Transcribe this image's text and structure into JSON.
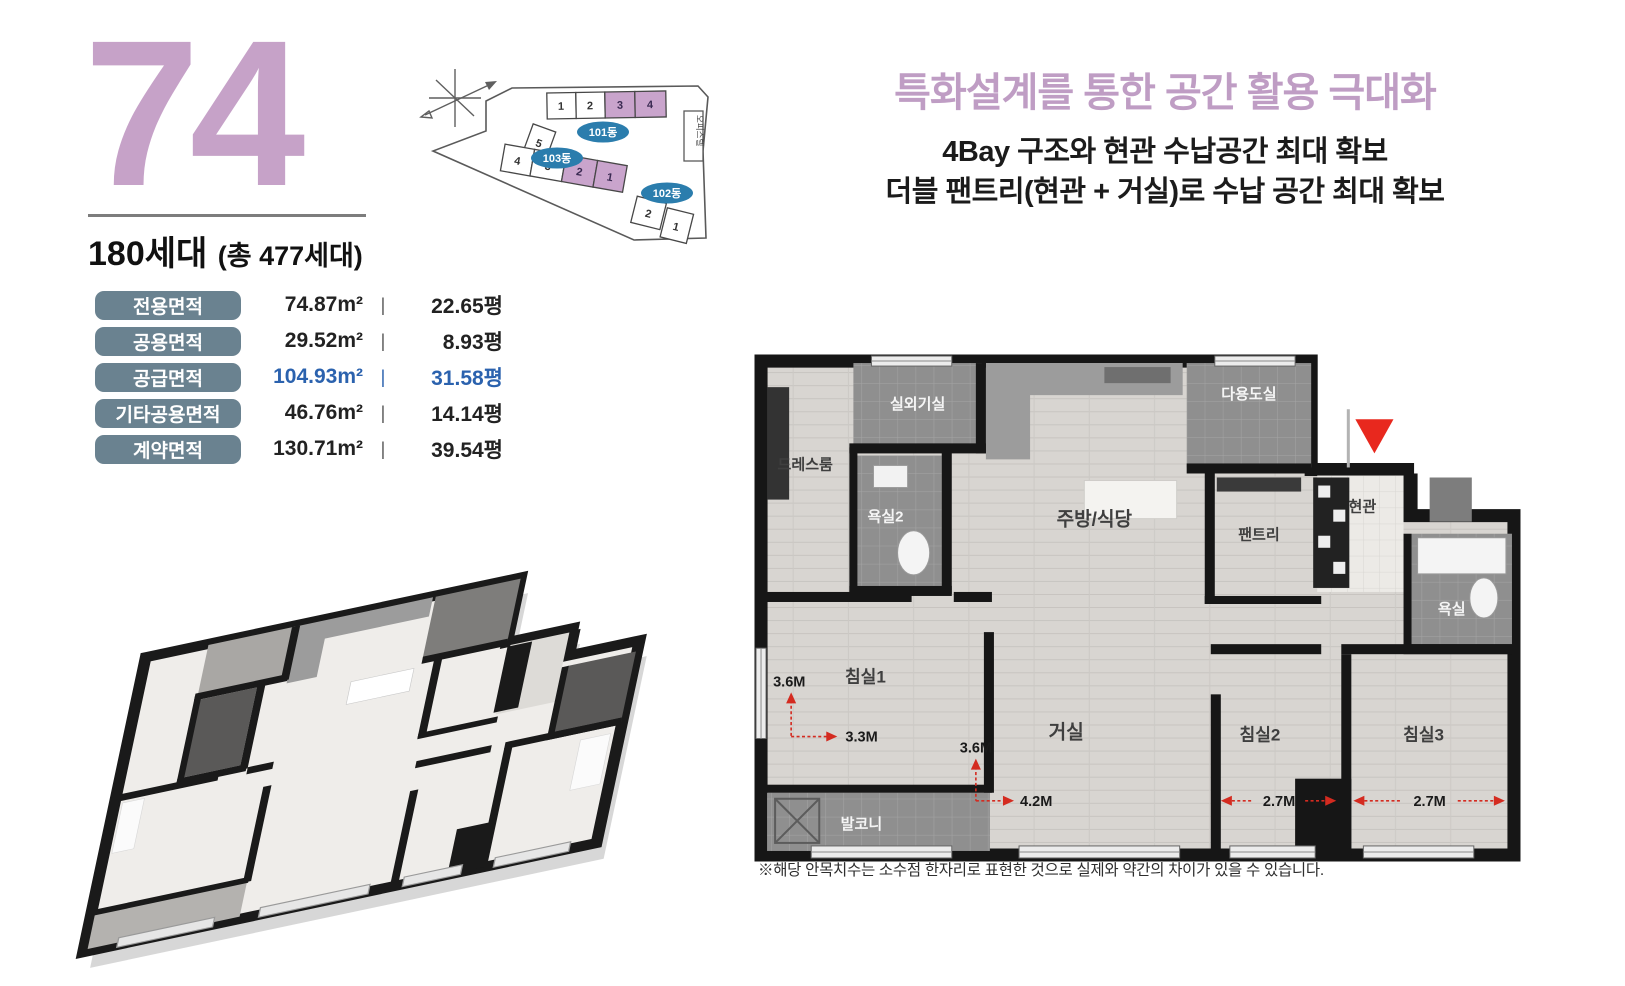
{
  "colors": {
    "accent_purple": "#c6a2c8",
    "headline_purple": "#bf9dc4",
    "pill_slate": "#6a8290",
    "value_blue": "#2b62ae",
    "building_label_blue": "#2b7dad",
    "highlight_unit_purple": "#c9a4cc",
    "dimension_red": "#e2281e",
    "wall_black": "#161616"
  },
  "unit": {
    "type_number": "74",
    "households": "180세대",
    "households_suffix": "(총 477세대)"
  },
  "area_table": {
    "divider": "|",
    "rows": [
      {
        "label": "전용면적",
        "sqm": "74.87m²",
        "pyeong": "22.65평"
      },
      {
        "label": "공용면적",
        "sqm": "29.52m²",
        "pyeong": "8.93평"
      },
      {
        "label": "공급면적",
        "sqm": "104.93m²",
        "pyeong": "31.58평"
      },
      {
        "label": "기타공용면적",
        "sqm": "46.76m²",
        "pyeong": "14.14평"
      },
      {
        "label": "계약면적",
        "sqm": "130.71m²",
        "pyeong": "39.54평"
      }
    ]
  },
  "site_map": {
    "annex": "오피스텔",
    "buildings": [
      {
        "name": "101동",
        "units": [
          "1",
          "2",
          "3",
          "4"
        ],
        "highlighted": [
          "3",
          "4"
        ]
      },
      {
        "name": "103동",
        "units": [
          "5",
          "4",
          "3",
          "2",
          "1"
        ],
        "highlighted": [
          "2",
          "1"
        ]
      },
      {
        "name": "102동",
        "units": [
          "2",
          "1"
        ],
        "highlighted": []
      }
    ]
  },
  "headline": {
    "title": "특화설계를 통한 공간 활용 극대화",
    "subtitle1": "4Bay 구조와 현관 수납공간 최대 확보",
    "subtitle2": "더블 팬트리(현관 + 거실)로 수납 공간 최대 확보"
  },
  "plan": {
    "rooms": {
      "outdoor_unit": "실외기실",
      "dress": "드레스룸",
      "bath2": "욕실2",
      "kitchen": "주방/식당",
      "utility": "다용도실",
      "pantry": "팬트리",
      "entry": "현관",
      "bath": "욕실",
      "bed1": "침실1",
      "living": "거실",
      "bed2": "침실2",
      "bed3": "침실3",
      "balcony": "발코니"
    },
    "dims": {
      "bed1_h": "3.6M",
      "bed1_w": "3.3M",
      "living_h": "3.6M",
      "living_w": "4.2M",
      "bed2_w": "2.7M",
      "bed3_w": "2.7M"
    }
  },
  "footnote": "※해당 안목치수는 소수점 한자리로 표현한 것으로 실제와 약간의 차이가 있을 수 있습니다."
}
